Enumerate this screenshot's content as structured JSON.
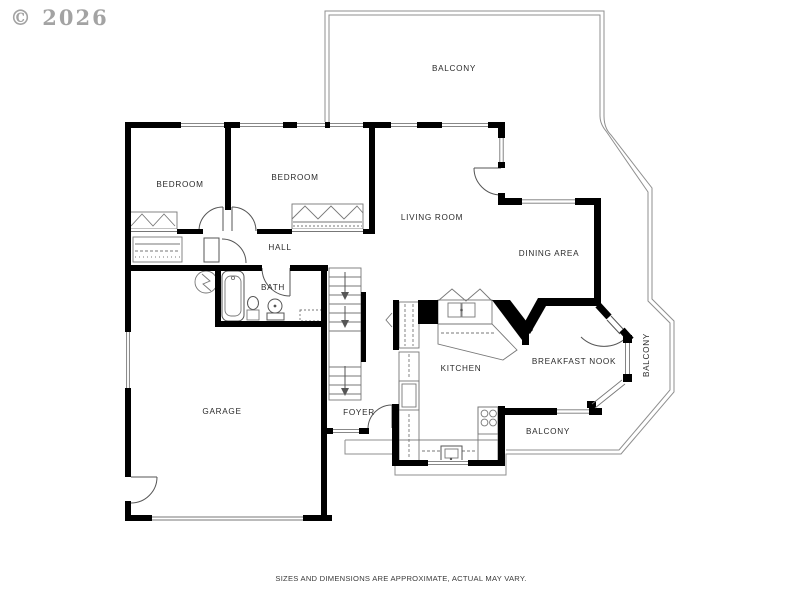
{
  "meta": {
    "watermark": "© 2026",
    "disclaimer": "SIZES AND DIMENSIONS ARE APPROXIMATE, ACTUAL MAY VARY."
  },
  "colors": {
    "wall": "#000000",
    "thin_line": "#555555",
    "balcony_line": "#8f8f8f",
    "label_text": "#2b2b2b",
    "watermark_text": "#a3a3a3",
    "background": "#ffffff"
  },
  "rooms": [
    {
      "id": "balcony-top",
      "label": "BALCONY"
    },
    {
      "id": "bedroom-1",
      "label": "BEDROOM"
    },
    {
      "id": "bedroom-2",
      "label": "BEDROOM"
    },
    {
      "id": "living-room",
      "label": "LIVING ROOM"
    },
    {
      "id": "dining-area",
      "label": "DINING AREA"
    },
    {
      "id": "hall",
      "label": "HALL"
    },
    {
      "id": "bath",
      "label": "BATH"
    },
    {
      "id": "kitchen",
      "label": "KITCHEN"
    },
    {
      "id": "breakfast-nook",
      "label": "BREAKFAST NOOK"
    },
    {
      "id": "garage",
      "label": "GARAGE"
    },
    {
      "id": "foyer",
      "label": "FOYER"
    },
    {
      "id": "balcony-side",
      "label": "BALCONY"
    },
    {
      "id": "balcony-bottom",
      "label": "BALCONY"
    }
  ]
}
